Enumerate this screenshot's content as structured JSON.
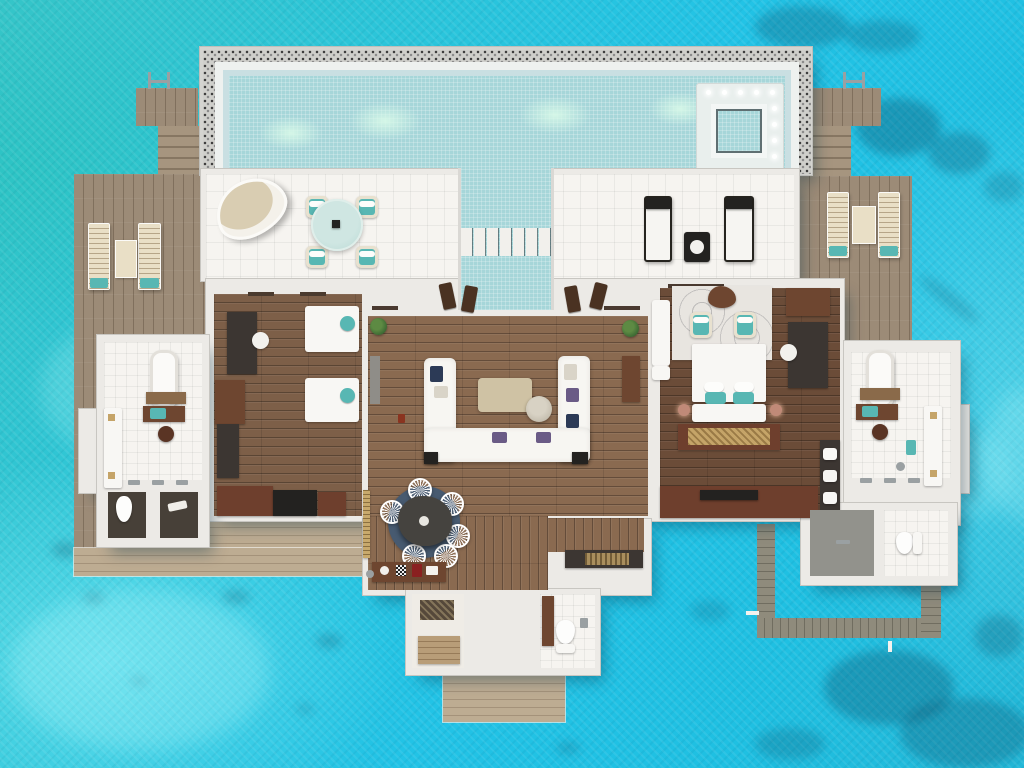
{
  "meta": {
    "render_type": "3d-floor-plan-top-view",
    "subject": "overwater-two-bedroom-pool-villa",
    "setting": "turquoise-lagoon"
  },
  "palette": {
    "water_teal": "#35c5c8",
    "water_cyan": "#22c3e6",
    "water_deep": "#0a4f6e",
    "water_light": "#9ff0f6",
    "pool_water": "#a6d6d9",
    "pool_rim": "#cfcfcb",
    "pool_inner_band": "#c9dfe2",
    "wall": "#eceae6",
    "wall_edge": "#c8c6c1",
    "floor_tile": "#f6f4f0",
    "deck": "#9c8b77",
    "deck_light": "#bdac92",
    "deck_frame": "#8f8b7c",
    "wood_bedroom": "#7d5f48",
    "wood_living": "#8a6a50",
    "wood_master": "#6b4c38",
    "furn_walnut": "#6e4630",
    "furn_mahogany": "#6e3f2d",
    "furn_dark": "#3c3632",
    "furn_black": "#232220",
    "accent_teal": "#58b7b3",
    "accent_navy": "#2c3a56",
    "accent_purple": "#6a5b86",
    "cream": "#e9dfc6",
    "beige": "#cfc2a4",
    "gold": "#c5a468",
    "white": "#f8f7f4",
    "rug_navy": "#475a70",
    "rug_light": "#e8e5e0",
    "metal": "#9aa0a2"
  },
  "scene": {
    "areas": [
      "lagoon-water",
      "lap-pool-with-mosaic-rim",
      "jacuzzi-with-lights",
      "sun-terrace",
      "pool-channel-with-stepping-stones",
      "left-sundeck-with-loungers",
      "right-sundeck-with-loungers",
      "guest-bedroom-twin",
      "living-room",
      "master-bedroom",
      "left-bathroom",
      "right-bathroom",
      "dining-area",
      "wet-bar",
      "luggage-room",
      "guest-wc",
      "entrance-deck",
      "water-access-frame"
    ],
    "furniture": [
      "egg-chair",
      "glass-patio-table",
      "patio-chairs",
      "chaise-lounges",
      "wooden-sun-loungers",
      "twin-beds",
      "writing-desk",
      "wardrobes",
      "u-shaped-sofa",
      "coffee-table",
      "side-table",
      "dining-table",
      "wire-chairs",
      "minibar-console",
      "king-bed",
      "bed-bench",
      "vanity-desks",
      "bathtubs",
      "toilets",
      "showers",
      "pool-ladders"
    ]
  }
}
